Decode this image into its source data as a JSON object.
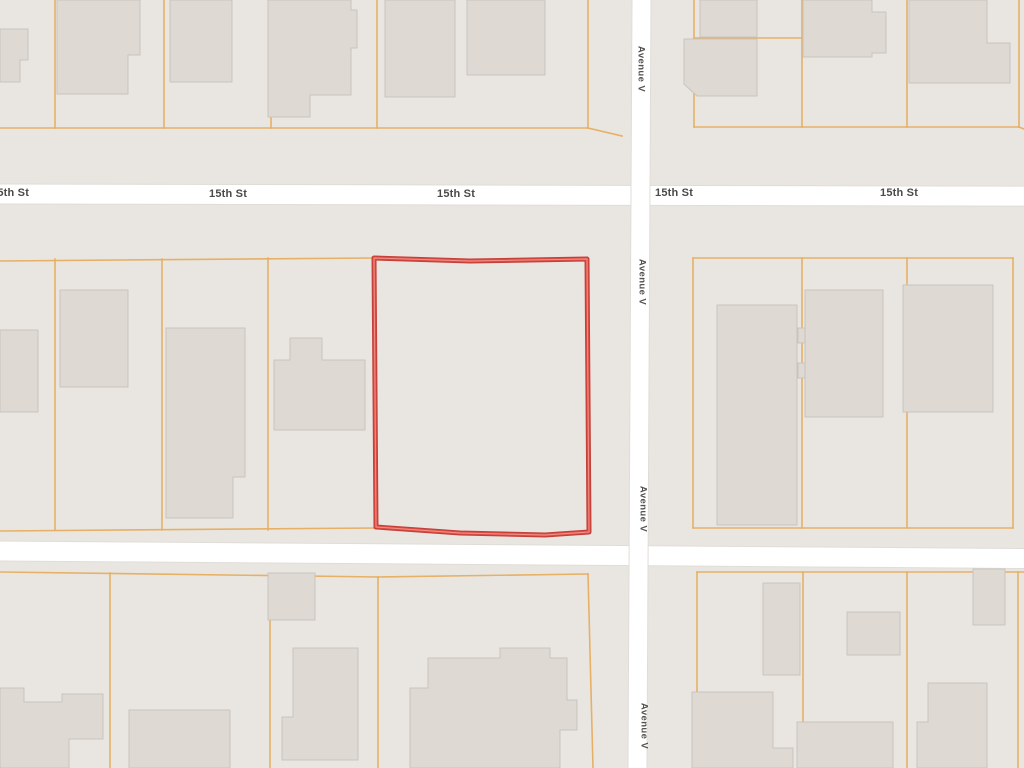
{
  "map": {
    "canvas": {
      "width": 1024,
      "height": 768
    },
    "colors": {
      "block": "#e9e6e1",
      "street_fill": "#ffffff",
      "street_edge": "#e0ddd8",
      "building_fill": "#ded9d3",
      "building_stroke": "#c9c4be",
      "parcel_line": "#e6ae60",
      "selection_outer": "#c4403a",
      "selection_mid": "#e05248",
      "selection_core": "#f2948c",
      "label_text": "#4a4a49"
    },
    "streets": [
      {
        "name": "15th St",
        "orient": "h",
        "x": -6,
        "y": 184,
        "w": 1040,
        "h": 20,
        "angle": 0.12
      },
      {
        "name": "",
        "orient": "h",
        "x": -6,
        "y": 541,
        "w": 1040,
        "h": 20,
        "angle": 0.42
      },
      {
        "name": "Avenue V",
        "orient": "v",
        "x": 632,
        "y": -6,
        "w": 19,
        "h": 782,
        "angle": 0.3
      }
    ],
    "h_labels": [
      {
        "text": "15th St",
        "x": -9,
        "y": 187
      },
      {
        "text": "15th St",
        "x": 209,
        "y": 188
      },
      {
        "text": "15th St",
        "x": 437,
        "y": 188
      },
      {
        "text": "15th St",
        "x": 655,
        "y": 187
      },
      {
        "text": "15th St",
        "x": 880,
        "y": 187
      }
    ],
    "v_labels": [
      {
        "text": "Avenue V",
        "cx": 641,
        "cy": 69
      },
      {
        "text": "Avenue V",
        "cx": 642,
        "cy": 282
      },
      {
        "text": "Avenue V",
        "cx": 643,
        "cy": 509
      },
      {
        "text": "Avenue V",
        "cx": 644,
        "cy": 726
      }
    ],
    "parcel_lines": [
      [
        55,
        0,
        55,
        128
      ],
      [
        164,
        0,
        164,
        128
      ],
      [
        271,
        0,
        271,
        128
      ],
      [
        377,
        0,
        377,
        128
      ],
      [
        588,
        0,
        588,
        128
      ],
      [
        0,
        128,
        588,
        128
      ],
      [
        588,
        128,
        622,
        136
      ],
      [
        694,
        0,
        694,
        127
      ],
      [
        802,
        0,
        802,
        127
      ],
      [
        907,
        0,
        907,
        127
      ],
      [
        1019,
        0,
        1019,
        127
      ],
      [
        694,
        38,
        802,
        38
      ],
      [
        694,
        127,
        1019,
        127
      ],
      [
        1019,
        127,
        1024,
        129
      ],
      [
        0,
        261,
        374,
        258
      ],
      [
        55,
        259,
        55,
        530
      ],
      [
        162,
        259,
        162,
        530
      ],
      [
        268,
        258,
        268,
        530
      ],
      [
        0,
        531,
        376,
        528
      ],
      [
        693,
        258,
        1013,
        258
      ],
      [
        693,
        258,
        693,
        528
      ],
      [
        802,
        258,
        802,
        528
      ],
      [
        907,
        258,
        907,
        528
      ],
      [
        1013,
        258,
        1013,
        528
      ],
      [
        693,
        528,
        1013,
        528
      ],
      [
        0,
        572,
        378,
        577
      ],
      [
        110,
        573,
        110,
        768
      ],
      [
        270,
        574,
        270,
        768
      ],
      [
        378,
        577,
        378,
        768
      ],
      [
        378,
        577,
        588,
        574
      ],
      [
        588,
        574,
        593,
        768
      ],
      [
        697,
        572,
        1024,
        572
      ],
      [
        697,
        572,
        697,
        768
      ],
      [
        803,
        572,
        803,
        768
      ],
      [
        907,
        572,
        907,
        768
      ],
      [
        1018,
        572,
        1018,
        768
      ]
    ],
    "buildings": [
      "0,29 28,29 28,60 20,60 20,82 0,82",
      "57,0 140,0 140,55 128,55 128,94 57,94",
      "170,0 232,0 232,82 170,82",
      "268,0 351,0 351,10 357,10 357,48 351,48 351,95 310,95 310,117 268,117",
      "385,0 455,0 455,97 385,97",
      "467,0 545,0 545,75 467,75",
      "700,0 757,0 757,37 700,37",
      "684,39 757,39 757,96 697,96 684,84",
      "803,0 872,0 872,12 886,12 886,53 872,53 872,57 803,57",
      "909,0 987,0 987,43 1010,43 1010,83 909,83",
      "0,330 38,330 38,412 0,412",
      "60,290 128,290 128,387 60,387",
      "166,328 245,328 245,477 233,477 233,518 166,518",
      "274,360 290,360 290,338 322,338 322,360 365,360 365,430 274,430",
      "717,305 797,305 797,525 717,525",
      "805,290 883,290 883,417 805,417",
      "798,328 805,328 805,343 798,343",
      "798,363 805,363 805,378 798,378",
      "903,285 993,285 993,412 903,412",
      "0,688 24,688 24,702 62,702 62,694 103,694 103,739 69,739 69,768 0,768",
      "268,573 315,573 315,620 268,620",
      "129,710 230,710 230,768 129,768",
      "293,648 358,648 358,760 282,760 282,717 293,717",
      "410,768 410,688 428,688 428,658 500,658 500,648 550,648 550,658 567,658 567,700 577,700 577,730 560,730 560,768",
      "763,583 800,583 800,675 763,675",
      "847,612 900,612 900,655 847,655",
      "973,569 1005,569 1005,625 973,625",
      "692,692 773,692 773,748 793,748 793,768 692,768",
      "797,722 893,722 893,768 797,768",
      "928,683 987,683 987,768 917,768 917,722 928,722"
    ],
    "selected_parcel": {
      "points": "374,258 470,261 587,259 589,532 545,535 460,533 376,527"
    }
  }
}
